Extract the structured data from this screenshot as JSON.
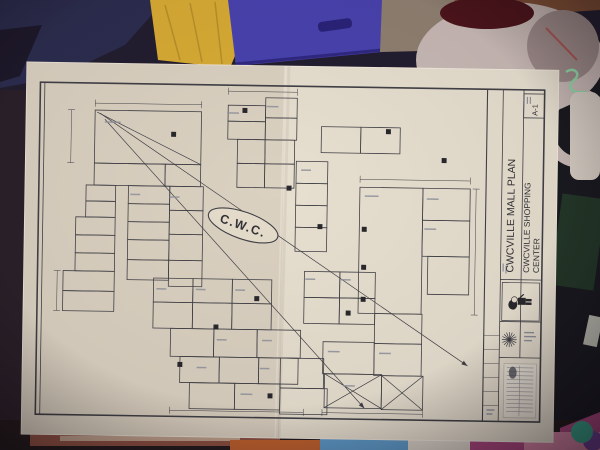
{
  "title_block": {
    "title": "CWCVILLE MALL PLAN",
    "subtitle_line1": "CWCVILLE SHOPPING",
    "subtitle_line2": "CENTER",
    "sheet_number": "A-1",
    "mascot_icon": "character-figure-icon",
    "star_icon": "starburst-icon",
    "stamp_icon": "dense-text-stamp-icon"
  },
  "plan": {
    "center_label": "C.W.C.",
    "rooms": [
      [
        70,
        47,
        108,
        53
      ],
      [
        70,
        100,
        72,
        22
      ],
      [
        142,
        100,
        36,
        22
      ],
      [
        62,
        122,
        30,
        16
      ],
      [
        62,
        138,
        30,
        16
      ],
      [
        52,
        154,
        40,
        18
      ],
      [
        52,
        172,
        40,
        18
      ],
      [
        52,
        190,
        40,
        18
      ],
      [
        40,
        208,
        52,
        20
      ],
      [
        40,
        228,
        52,
        20
      ],
      [
        105,
        122,
        42,
        18
      ],
      [
        105,
        140,
        42,
        18
      ],
      [
        105,
        158,
        42,
        18
      ],
      [
        105,
        176,
        42,
        20
      ],
      [
        105,
        196,
        42,
        20
      ],
      [
        147,
        122,
        34,
        24
      ],
      [
        147,
        146,
        34,
        24
      ],
      [
        147,
        170,
        34,
        26
      ],
      [
        147,
        196,
        34,
        26
      ],
      [
        205,
        40,
        38,
        16
      ],
      [
        205,
        56,
        38,
        18
      ],
      [
        243,
        32,
        32,
        20
      ],
      [
        243,
        52,
        32,
        22
      ],
      [
        215,
        74,
        28,
        24
      ],
      [
        215,
        98,
        28,
        24
      ],
      [
        243,
        74,
        30,
        24
      ],
      [
        243,
        98,
        30,
        24
      ],
      [
        275,
        95,
        32,
        22
      ],
      [
        275,
        117,
        32,
        22
      ],
      [
        275,
        139,
        32,
        22
      ],
      [
        275,
        161,
        32,
        24
      ],
      [
        300,
        60,
        40,
        26
      ],
      [
        340,
        60,
        40,
        26
      ],
      [
        340,
        120,
        64,
        126
      ],
      [
        404,
        120,
        48,
        32
      ],
      [
        404,
        152,
        48,
        36
      ],
      [
        410,
        188,
        42,
        38
      ],
      [
        285,
        205,
        36,
        26
      ],
      [
        321,
        205,
        36,
        26
      ],
      [
        285,
        231,
        36,
        26
      ],
      [
        321,
        231,
        36,
        26
      ],
      [
        357,
        246,
        48,
        30
      ],
      [
        132,
        214,
        40,
        24
      ],
      [
        172,
        214,
        40,
        24
      ],
      [
        212,
        214,
        40,
        24
      ],
      [
        132,
        238,
        40,
        26
      ],
      [
        172,
        238,
        40,
        26
      ],
      [
        212,
        238,
        40,
        26
      ],
      [
        150,
        264,
        44,
        28
      ],
      [
        194,
        264,
        44,
        28
      ],
      [
        238,
        264,
        44,
        28
      ],
      [
        160,
        292,
        40,
        26
      ],
      [
        200,
        292,
        40,
        26
      ],
      [
        240,
        292,
        40,
        26
      ],
      [
        170,
        318,
        46,
        26
      ],
      [
        216,
        318,
        46,
        26
      ],
      [
        305,
        275,
        52,
        32
      ],
      [
        357,
        276,
        48,
        32
      ],
      [
        307,
        307,
        58,
        34
      ],
      [
        365,
        308,
        42,
        34
      ],
      [
        262,
        292,
        44,
        30
      ],
      [
        262,
        322,
        48,
        26
      ]
    ],
    "markers": [
      [
        150,
        70
      ],
      [
        425,
        92
      ],
      [
        268,
        122
      ],
      [
        300,
        160
      ],
      [
        345,
        162
      ],
      [
        345,
        200
      ],
      [
        345,
        232
      ],
      [
        237,
        233
      ],
      [
        196,
        262
      ],
      [
        330,
        246
      ],
      [
        160,
        300
      ],
      [
        252,
        330
      ],
      [
        222,
        45
      ],
      [
        368,
        64
      ]
    ],
    "diagonals": [
      [
        75,
        50,
        452,
        297,
        1
      ],
      [
        80,
        56,
        348,
        341,
        1
      ],
      [
        72,
        49,
        178,
        100,
        0
      ],
      [
        307,
        307,
        365,
        341,
        0
      ],
      [
        365,
        307,
        307,
        341,
        0
      ],
      [
        365,
        308,
        407,
        342,
        0
      ],
      [
        407,
        308,
        365,
        342,
        0
      ]
    ],
    "dims": [
      [
        70,
        40,
        178,
        40
      ],
      [
        205,
        26,
        275,
        26
      ],
      [
        340,
        112,
        452,
        112
      ],
      [
        458,
        120,
        458,
        246
      ],
      [
        46,
        47,
        46,
        100
      ],
      [
        34,
        208,
        34,
        248
      ],
      [
        150,
        346,
        286,
        346
      ],
      [
        305,
        346,
        407,
        346
      ]
    ],
    "label_marks": [
      [
        88,
        58,
        16
      ],
      [
        210,
        47,
        12
      ],
      [
        250,
        40,
        12
      ],
      [
        112,
        130,
        10
      ],
      [
        152,
        132,
        10
      ],
      [
        352,
        128,
        14
      ],
      [
        414,
        130,
        12
      ],
      [
        291,
        212,
        10
      ],
      [
        327,
        212,
        10
      ],
      [
        140,
        224,
        10
      ],
      [
        180,
        224,
        10
      ],
      [
        220,
        224,
        10
      ],
      [
        316,
        284,
        12
      ],
      [
        368,
        285,
        12
      ],
      [
        202,
        274,
        10
      ],
      [
        248,
        274,
        10
      ],
      [
        182,
        302,
        10
      ],
      [
        246,
        302,
        10
      ],
      [
        228,
        328,
        12
      ],
      [
        332,
        318,
        12
      ],
      [
        412,
        160,
        12
      ],
      [
        285,
        103,
        10
      ]
    ]
  },
  "colors": {
    "paper": "#e7e0d1",
    "ink": "#3b3e46",
    "navy": "#262a50",
    "navy_dark": "#17152a",
    "basket_yellow": "#d9ad33",
    "bin_blue": "#4340b2",
    "carpet": "#8d8173",
    "wood": "#7d4e35",
    "jug_white": "#c8bcba",
    "jug_red": "#471019",
    "cap_gray": "#9c8c8c",
    "right_dark": "#12151f",
    "tie_green": "#8fdcab",
    "roll_white": "#d8d2c9",
    "dark_green": "#1d3527",
    "teal": "#35a78e",
    "bottom_dark": "#1d161a",
    "stripe_red": "#a15a4a",
    "stripe_cream": "#d9c9b4",
    "pile_orange": "#c4622e",
    "pile_blue": "#5b9ed2",
    "pile_magenta": "#aa4480",
    "pile_pink": "#d884a6",
    "pile_purple": "#6e3f98",
    "pile_white": "#e0dbd2"
  }
}
